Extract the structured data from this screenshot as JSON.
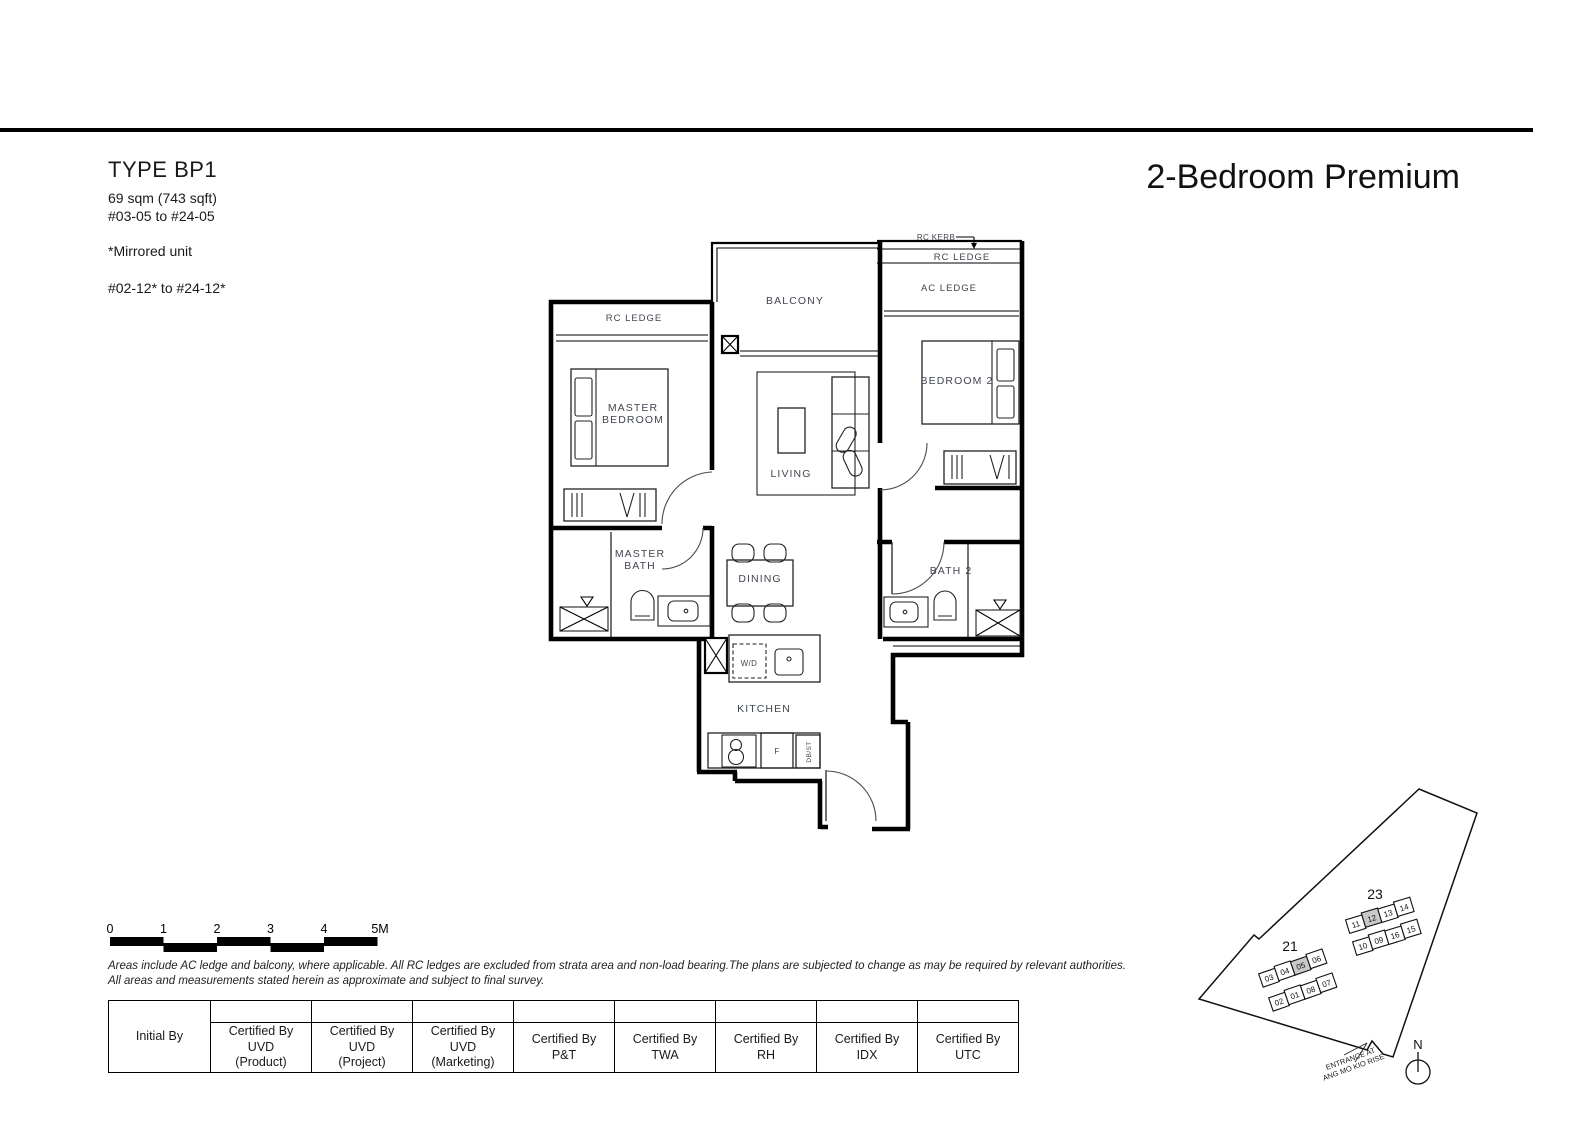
{
  "page": {
    "type_label": "TYPE BP1",
    "area": "69 sqm (743 sqft)",
    "stack_range_1": "#03-05 to #24-05",
    "mirrored_note": "*Mirrored unit",
    "stack_range_2": "#02-12* to #24-12*",
    "unit_name": "2-Bedroom Premium"
  },
  "floorplan": {
    "labels": {
      "balcony": "BALCONY",
      "rc_kerb": "RC KERB",
      "rc_ledge_left": "RC LEDGE",
      "rc_ledge_right": "RC LEDGE",
      "ac_ledge": "AC LEDGE",
      "master_bedroom": [
        "MASTER",
        "BEDROOM"
      ],
      "bedroom2": "BEDROOM 2",
      "living": "LIVING",
      "master_bath": [
        "MASTER",
        "BATH"
      ],
      "dining": "DINING",
      "bath2": "BATH 2",
      "kitchen": "KITCHEN",
      "wd": "W/D",
      "fridge": "F",
      "dbst": "DB/ST"
    }
  },
  "scalebar": {
    "ticks": [
      "0",
      "1",
      "2",
      "3",
      "4",
      "5M"
    ]
  },
  "disclaimer": {
    "line1": "Areas include AC ledge and balcony, where applicable. All RC ledges are excluded from strata area and non-load bearing.The plans are subjected to change as may be required by relevant authorities.",
    "line2": "All areas and measurements stated herein as approximate and subject to final survey."
  },
  "table": {
    "columns": [
      {
        "lines": [
          "Initial By"
        ]
      },
      {
        "lines": [
          "Certified By",
          "UVD",
          "(Product)"
        ]
      },
      {
        "lines": [
          "Certified By",
          "UVD",
          "(Project)"
        ]
      },
      {
        "lines": [
          "Certified By",
          "UVD",
          "(Marketing)"
        ]
      },
      {
        "lines": [
          "Certified By",
          "P&T"
        ]
      },
      {
        "lines": [
          "Certified By",
          "TWA"
        ]
      },
      {
        "lines": [
          "Certified By",
          "RH"
        ]
      },
      {
        "lines": [
          "Certified By",
          "IDX"
        ]
      },
      {
        "lines": [
          "Certified By",
          "UTC"
        ]
      }
    ]
  },
  "siteplan": {
    "block21": {
      "label": "21",
      "top_units": [
        "03",
        "04",
        "05",
        "06"
      ],
      "bottom_units": [
        "02",
        "01",
        "08",
        "07"
      ],
      "highlighted_unit": "05"
    },
    "block23": {
      "label": "23",
      "top_units": [
        "11",
        "12",
        "13",
        "14"
      ],
      "bottom_units": [
        "10",
        "09",
        "16",
        "15"
      ],
      "highlighted_unit": "12"
    },
    "north_label": "N",
    "entrance_line1": "ENTRANCE AT",
    "entrance_line2": "ANG MO KIO RISE",
    "highlight_color": "#c9c9c9"
  }
}
